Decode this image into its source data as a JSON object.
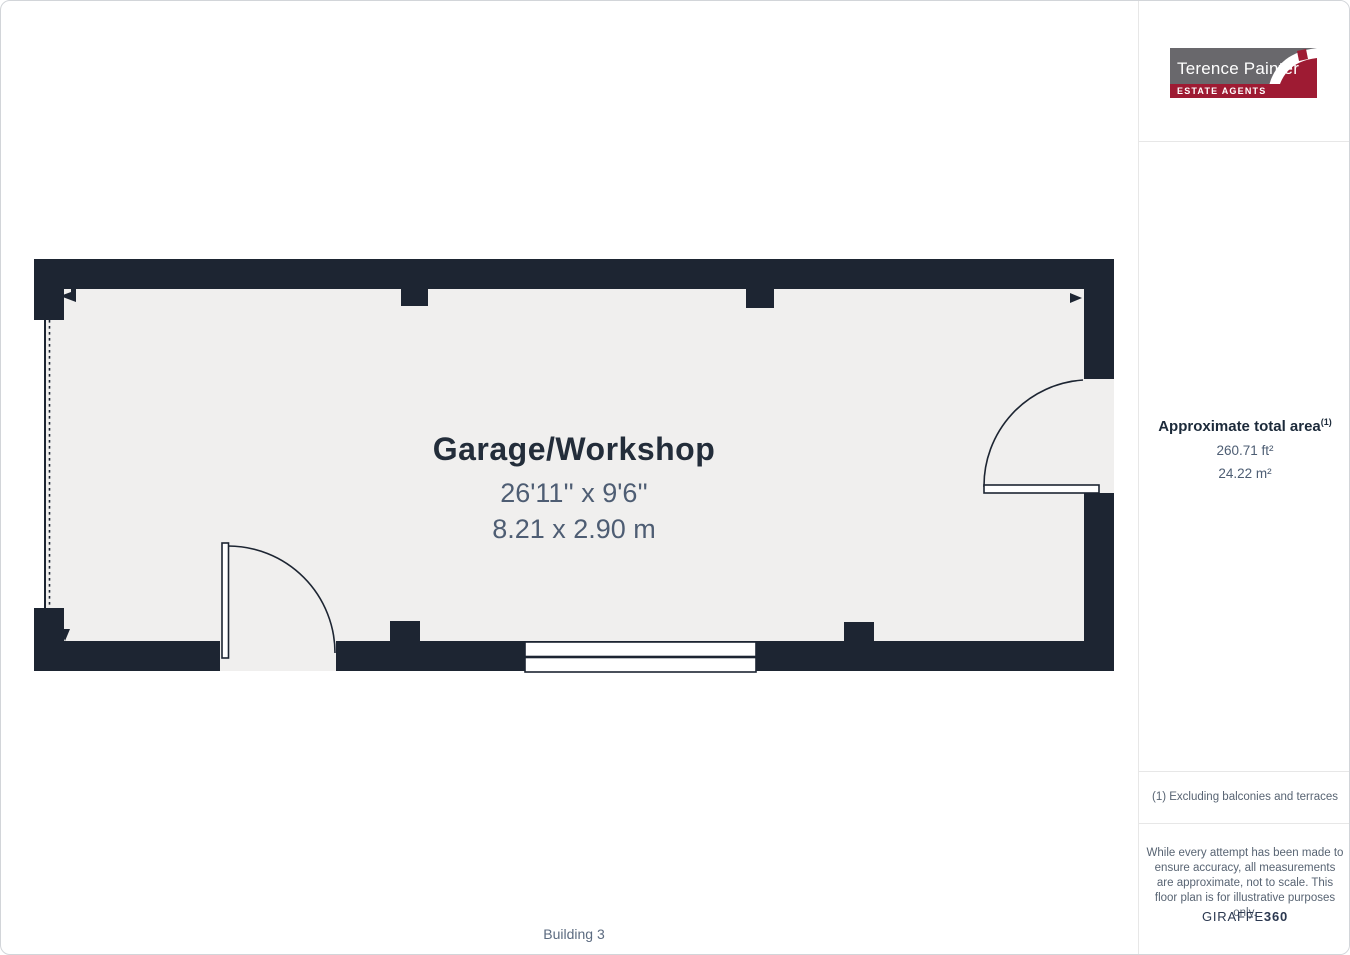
{
  "branding": {
    "agency_name": "Terence Painter",
    "agency_tagline": "ESTATE AGENTS"
  },
  "floorplan": {
    "room_name": "Garage/Workshop",
    "dimensions_imperial": "26'11'' x 9'6''",
    "dimensions_metric": "8.21 x 2.90 m",
    "building_label": "Building 3"
  },
  "sidebar": {
    "area_heading": "Approximate total area",
    "area_heading_superscript": "(1)",
    "area_ft": "260.71 ft²",
    "area_m": "24.22 m²",
    "footnote": "(1) Excluding balconies and terraces",
    "disclaimer": "While every attempt has been made to ensure accuracy, all measurements are approximate, not to scale. This floor plan is for illustrative purposes only.",
    "brand_name": "GIRAFFE",
    "brand_suffix": "360"
  },
  "colors": {
    "wall": "#1d2532",
    "floor": "#f0efee",
    "title": "#232d3a",
    "dims": "#4e5d73",
    "sidebar_text": "#586473",
    "values": "#4d5d73",
    "giraffe": "#2b3850",
    "building": "#5c6b80",
    "logo_gray": "#69686c",
    "logo_red": "#9e1b33",
    "divider": "#e7e7e7",
    "canvas_border": "#d2d5d9"
  }
}
